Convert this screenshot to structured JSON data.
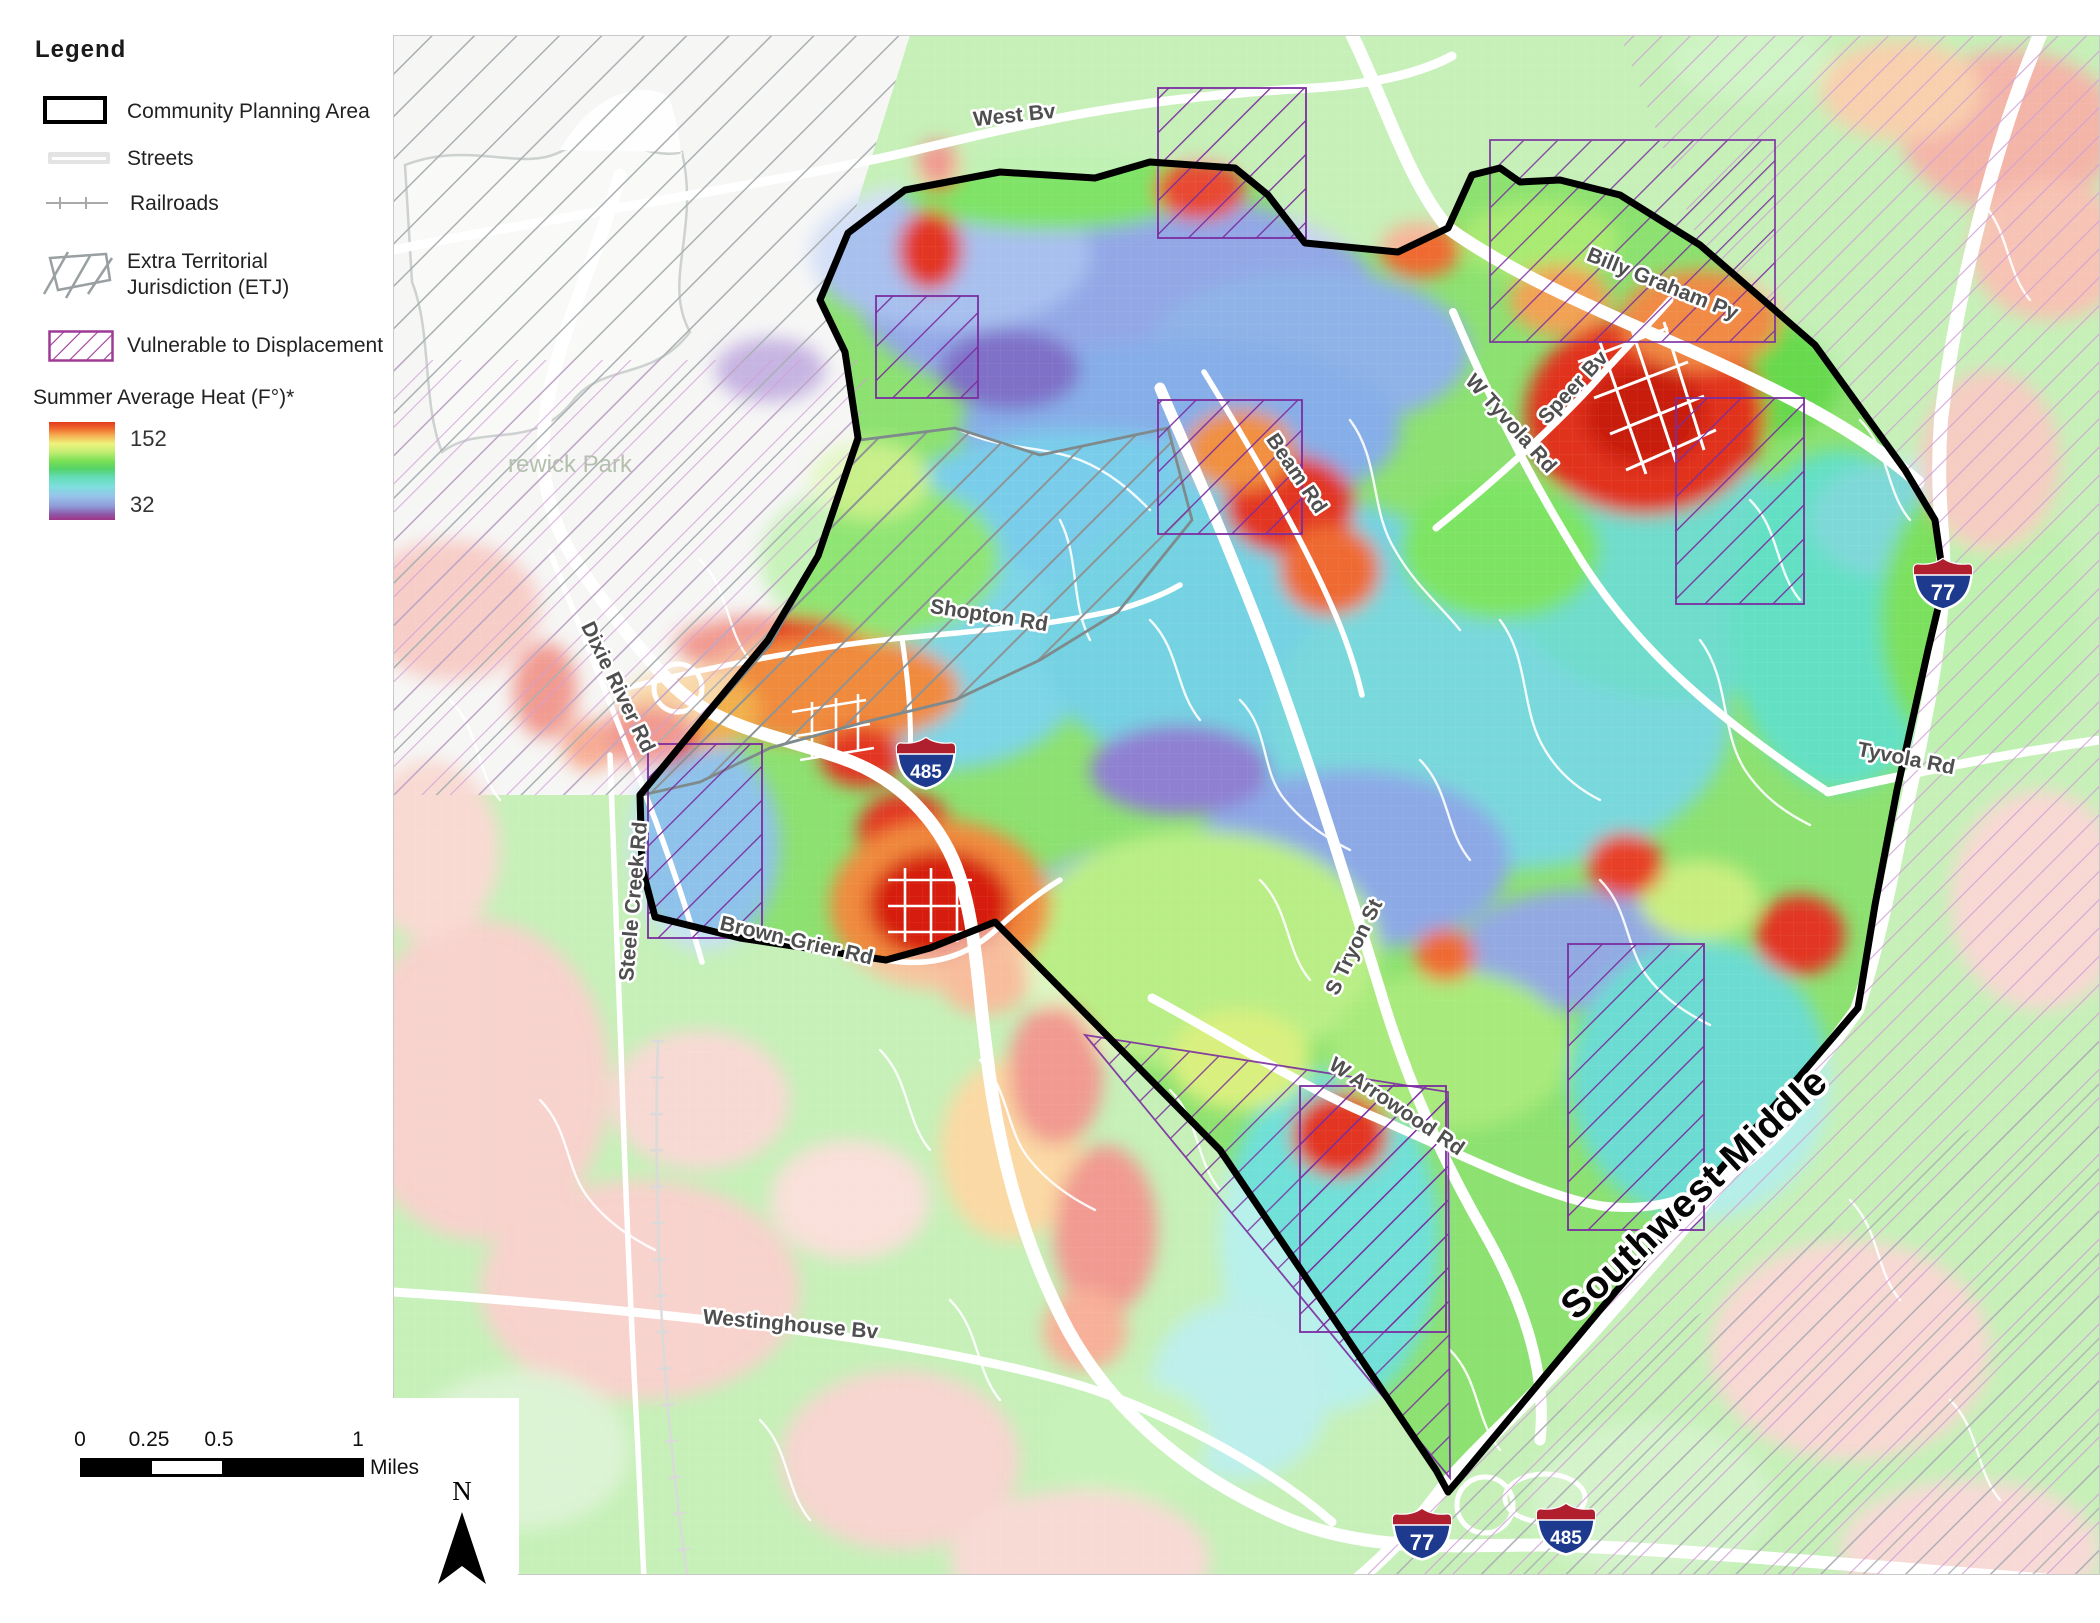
{
  "legend": {
    "title": "Legend",
    "items": [
      {
        "label": "Community Planning Area"
      },
      {
        "label": "Streets"
      },
      {
        "label": "Railroads"
      },
      {
        "label_line1": "Extra Territorial",
        "label_line2": "Jurisdiction (ETJ)"
      },
      {
        "label": "Vulnerable to Displacement"
      }
    ],
    "heat_section": {
      "title": "Summer Average Heat (F°)*",
      "max_value": "152",
      "min_value": "32"
    }
  },
  "scale_bar": {
    "tick_labels": [
      "0",
      "0.25",
      "0.5",
      "1"
    ],
    "unit_label": "Miles"
  },
  "north_arrow": {
    "label": "N"
  },
  "map": {
    "planning_area_label": "Southwest Middle",
    "park_label": "rewick Park",
    "road_labels": {
      "west_bv": "West Bv",
      "billy_graham": "Billy Graham Py",
      "speer_bv": "Speer Bv",
      "w_tyvola": "W Tyvola Rd",
      "beam_rd": "Beam Rd",
      "shopton_rd": "Shopton Rd",
      "dixie_river": "Dixie River Rd",
      "steele_creek": "Steele Creek Rd",
      "brown_grier": "Brown-Grier Rd",
      "s_tryon": "S Tryon St",
      "w_arrowood": "W Arrowood Rd",
      "westinghouse": "Westinghouse Bv",
      "tyvola_rd": "Tyvola Rd"
    },
    "highway_shields": [
      {
        "route": "485"
      },
      {
        "route": "77"
      },
      {
        "route": "77"
      },
      {
        "route": "485"
      }
    ],
    "heat_scale": {
      "max": 152,
      "min": 32,
      "units": "F"
    }
  },
  "colors": {
    "heat_max": "#e33a1e",
    "heat_min": "#a03386",
    "vulnerable_hatch": "#7b2da0",
    "etj_hatch": "#8e9496",
    "boundary": "#000000",
    "road": "#ffffff"
  }
}
